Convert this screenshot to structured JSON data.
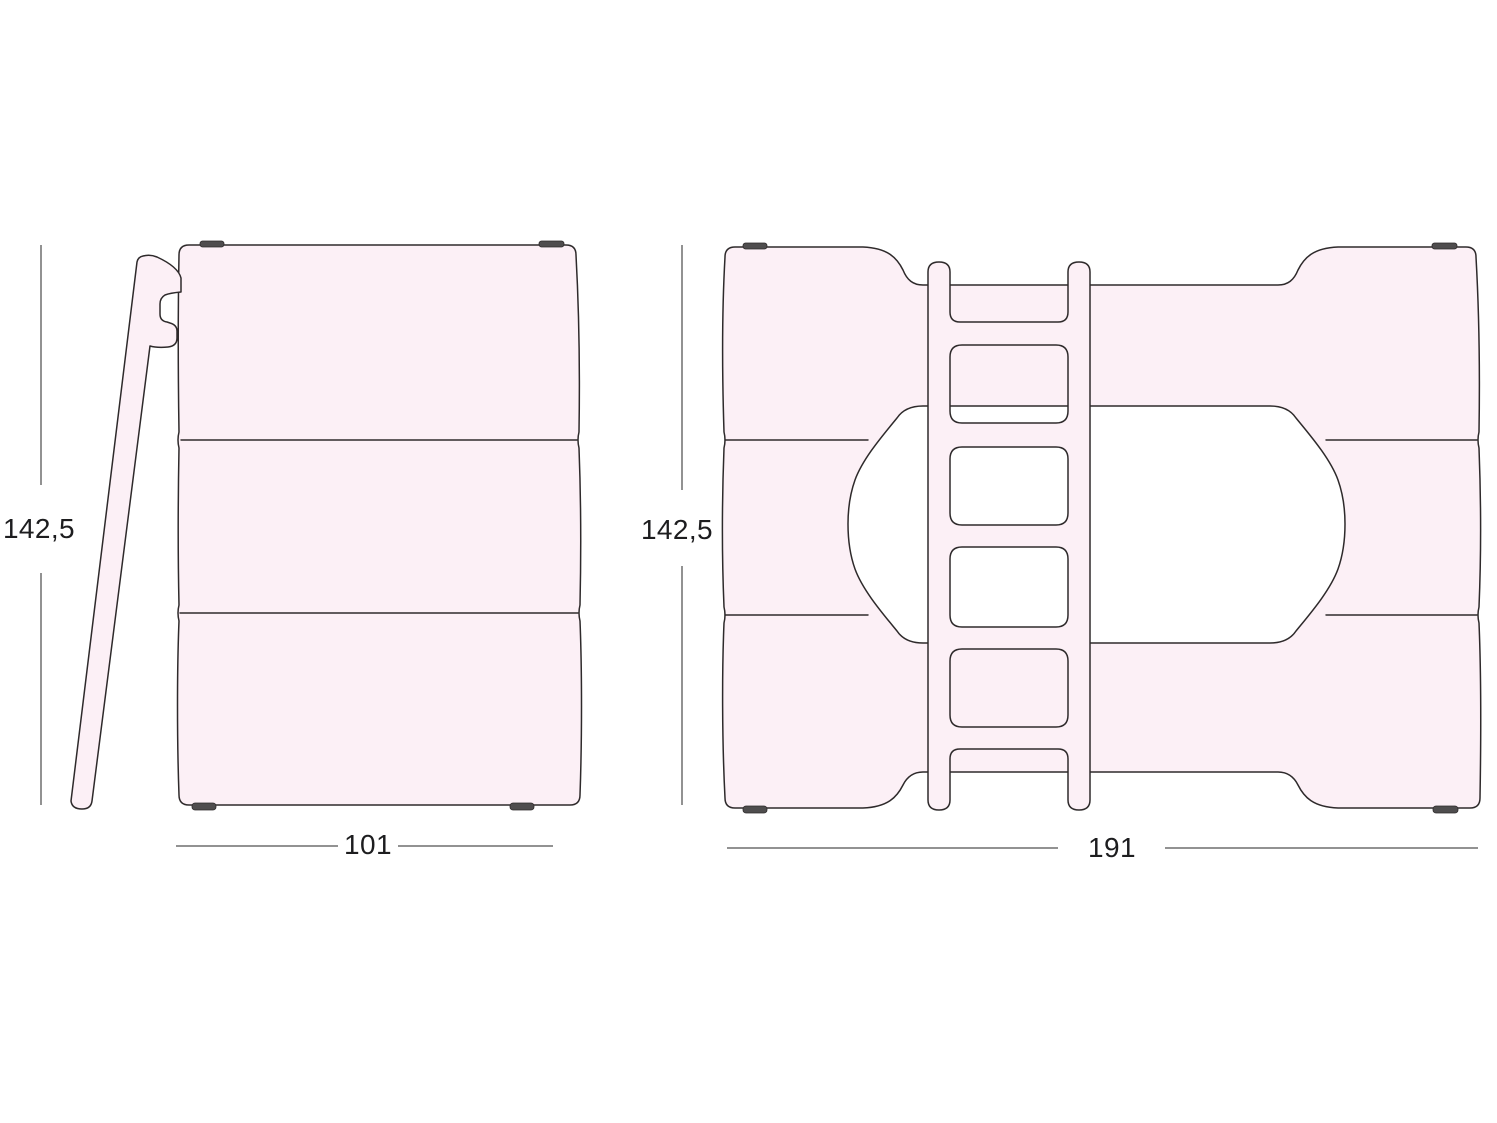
{
  "views": {
    "side": {
      "name": "side-view",
      "height_label": "142,5",
      "width_label": "101"
    },
    "front": {
      "name": "front-view",
      "height_label": "142,5",
      "width_label": "191"
    }
  },
  "colors": {
    "fill": "#fcf0f6",
    "cutout": "#ffffff",
    "outline": "#2e2a2b",
    "hardware": "#4f4d4e",
    "dimension_line": "#6f6f6f",
    "label_text": "#1d1d1f"
  }
}
